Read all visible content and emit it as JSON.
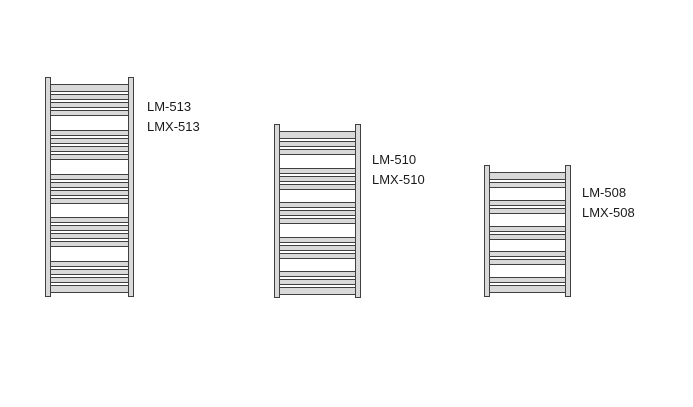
{
  "page": {
    "width": 693,
    "height": 407,
    "background": "#ffffff"
  },
  "diagram": {
    "title": "Ladder towel radiator size variants",
    "colors": {
      "fill": "#d9d9d9",
      "outline": "#404040",
      "text": "#1a1a1a"
    },
    "radiators": [
      {
        "id": "lm-513",
        "labels": [
          "LM-513",
          "LMX-513"
        ],
        "rung_groups": 5,
        "rungs_per_group": 4,
        "total_rungs": 20,
        "geometry": {
          "x": 45,
          "y": 77,
          "width": 89,
          "height": 220,
          "post_width": 6,
          "rung_area": {
            "x": 5,
            "y": 7,
            "width": 79,
            "height": 209
          }
        },
        "label_pos": {
          "x": 147,
          "y": 97
        }
      },
      {
        "id": "lm-510",
        "labels": [
          "LM-510",
          "LMX-510"
        ],
        "rung_groups": 5,
        "rungs_per_group": 3,
        "total_rungs": 15,
        "geometry": {
          "x": 274,
          "y": 124,
          "width": 87,
          "height": 174,
          "post_width": 6,
          "rung_area": {
            "x": 5,
            "y": 7,
            "width": 77,
            "height": 164
          }
        },
        "label_pos": {
          "x": 372,
          "y": 150
        }
      },
      {
        "id": "lm-508",
        "labels": [
          "LM-508",
          "LMX-508"
        ],
        "rung_groups": 5,
        "rungs_per_group": 2,
        "total_rungs": 10,
        "geometry": {
          "x": 484,
          "y": 165,
          "width": 87,
          "height": 132,
          "post_width": 6,
          "rung_area": {
            "x": 5,
            "y": 7,
            "width": 77,
            "height": 121
          }
        },
        "label_pos": {
          "x": 582,
          "y": 183
        }
      }
    ]
  }
}
